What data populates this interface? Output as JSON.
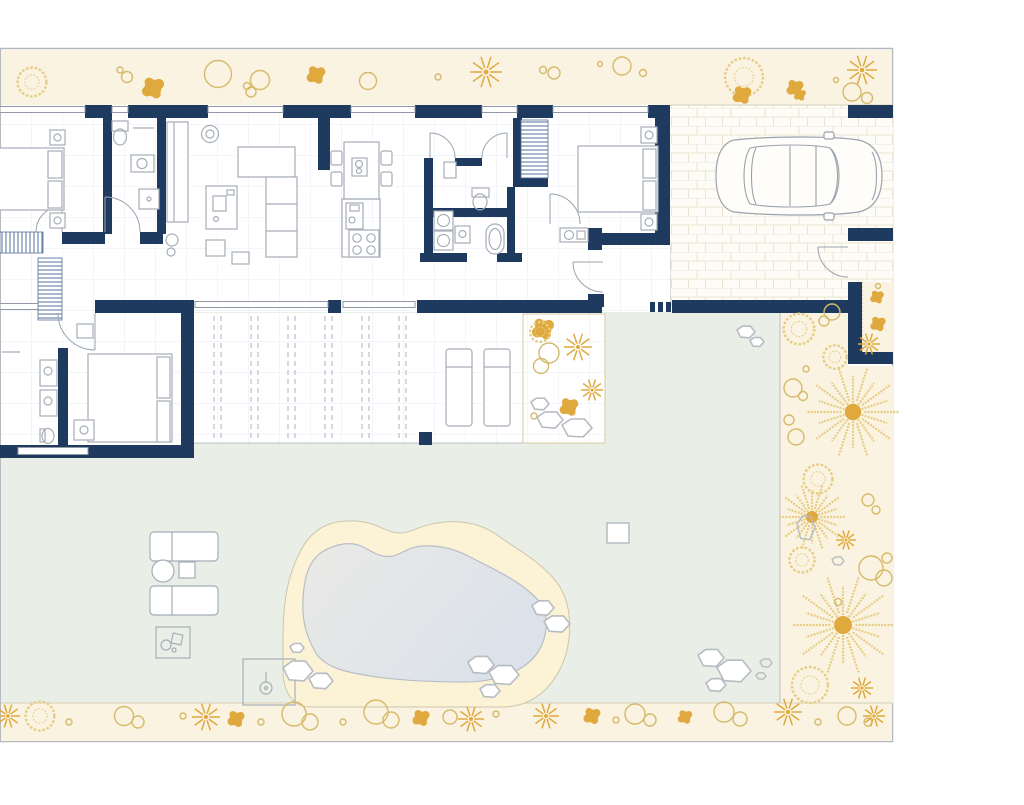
{
  "palette": {
    "wall": "#1e3b5f",
    "frame": "#b6bac0",
    "cream": "#faf3e2",
    "cream-line": "#d5cfb6",
    "green": "#e9efe6",
    "deck": "#fcf3d7",
    "deck-line": "#cdc6ab",
    "water1": "#eaeae7",
    "water2": "#dce2ea",
    "water-line": "#b9bec6",
    "gold": "#e0a93e",
    "gold-line": "#d6ba6b",
    "gold-soft": "#e7cd82",
    "furn": "#a6aeb8",
    "door": "#9aa3ae",
    "sand-line": "#d9c9a0"
  },
  "pergola": {
    "x1": 214,
    "x2": 406,
    "y1": 316,
    "y2": 440,
    "pair_gap": 7,
    "spacing": 37
  },
  "inventory": {
    "bedrooms": 3,
    "bathrooms": 3,
    "kitchen_islands": 1,
    "sofas": 1,
    "sun_loungers_terrace": 2,
    "sun_loungers_garden": 2,
    "cars": 1,
    "pools": 1,
    "palm_trees": 3,
    "outdoor_showers": 1,
    "staircases": 1
  },
  "decor": [
    {
      "t": "wreath",
      "x": 32,
      "y": 82,
      "s": 1.6
    },
    {
      "t": "circle",
      "x": 120,
      "y": 70,
      "s": 0.3
    },
    {
      "t": "circle",
      "x": 127,
      "y": 77,
      "s": 0.55
    },
    {
      "t": "blob",
      "x": 153,
      "y": 88,
      "s": 1.3
    },
    {
      "t": "circle",
      "x": 218,
      "y": 74,
      "s": 1.35
    },
    {
      "t": "circle",
      "x": 247,
      "y": 86,
      "s": 0.35
    },
    {
      "t": "circle",
      "x": 260,
      "y": 80,
      "s": 0.95
    },
    {
      "t": "circle",
      "x": 251,
      "y": 92,
      "s": 0.5
    },
    {
      "t": "blob",
      "x": 316,
      "y": 75,
      "s": 1.1
    },
    {
      "t": "circle",
      "x": 368,
      "y": 81,
      "s": 0.85
    },
    {
      "t": "circle",
      "x": 438,
      "y": 77,
      "s": 0.3
    },
    {
      "t": "star",
      "x": 486,
      "y": 72,
      "s": 1.6
    },
    {
      "t": "circle",
      "x": 543,
      "y": 70,
      "s": 0.35
    },
    {
      "t": "circle",
      "x": 554,
      "y": 73,
      "s": 0.6
    },
    {
      "t": "circle",
      "x": 600,
      "y": 64,
      "s": 0.25
    },
    {
      "t": "circle",
      "x": 622,
      "y": 66,
      "s": 0.9
    },
    {
      "t": "circle",
      "x": 643,
      "y": 73,
      "s": 0.35
    },
    {
      "t": "wreath",
      "x": 744,
      "y": 77,
      "s": 2.1
    },
    {
      "t": "blob",
      "x": 795,
      "y": 88,
      "s": 1.0
    },
    {
      "t": "star",
      "x": 862,
      "y": 70,
      "s": 1.5
    },
    {
      "t": "circle",
      "x": 852,
      "y": 92,
      "s": 0.9
    },
    {
      "t": "circle",
      "x": 867,
      "y": 98,
      "s": 0.55
    },
    {
      "t": "circle",
      "x": 836,
      "y": 80,
      "s": 0.25
    },
    {
      "t": "blob",
      "x": 742,
      "y": 95,
      "s": 1.1
    },
    {
      "t": "blob",
      "x": 800,
      "y": 95,
      "s": 0.7
    },
    {
      "t": "blob",
      "x": 877,
      "y": 297,
      "s": 0.8
    },
    {
      "t": "blob",
      "x": 878,
      "y": 324,
      "s": 0.9
    },
    {
      "t": "star",
      "x": 869,
      "y": 344,
      "s": 1.1
    },
    {
      "t": "circle",
      "x": 878,
      "y": 286,
      "s": 0.25
    },
    {
      "t": "wreath",
      "x": 799,
      "y": 329,
      "s": 1.7
    },
    {
      "t": "circle",
      "x": 824,
      "y": 321,
      "s": 0.5
    },
    {
      "t": "circle",
      "x": 832,
      "y": 312,
      "s": 0.8
    },
    {
      "t": "wreath",
      "x": 835,
      "y": 357,
      "s": 1.3
    },
    {
      "t": "circle",
      "x": 806,
      "y": 369,
      "s": 0.3
    },
    {
      "t": "circle",
      "x": 793,
      "y": 388,
      "s": 0.9
    },
    {
      "t": "circle",
      "x": 803,
      "y": 396,
      "s": 0.45
    },
    {
      "t": "palm",
      "x": 853,
      "y": 412,
      "s": 4.6
    },
    {
      "t": "circle",
      "x": 789,
      "y": 420,
      "s": 0.5
    },
    {
      "t": "circle",
      "x": 796,
      "y": 437,
      "s": 0.8
    },
    {
      "t": "wreath",
      "x": 818,
      "y": 479,
      "s": 1.6
    },
    {
      "t": "palm",
      "x": 812,
      "y": 517,
      "s": 3.4
    },
    {
      "t": "gstone",
      "x": 806,
      "y": 528,
      "w": 18,
      "h": 26
    },
    {
      "t": "star",
      "x": 846,
      "y": 540,
      "s": 1.0
    },
    {
      "t": "circle",
      "x": 868,
      "y": 500,
      "s": 0.6
    },
    {
      "t": "circle",
      "x": 876,
      "y": 510,
      "s": 0.4
    },
    {
      "t": "wreath",
      "x": 802,
      "y": 560,
      "s": 1.4
    },
    {
      "t": "gstone",
      "x": 838,
      "y": 561,
      "w": 12,
      "h": 9
    },
    {
      "t": "circle",
      "x": 871,
      "y": 568,
      "s": 1.2
    },
    {
      "t": "circle",
      "x": 884,
      "y": 578,
      "s": 0.8
    },
    {
      "t": "circle",
      "x": 887,
      "y": 558,
      "s": 0.5
    },
    {
      "t": "palm",
      "x": 843,
      "y": 625,
      "s": 5.0
    },
    {
      "t": "circle",
      "x": 838,
      "y": 602,
      "s": 0.35
    },
    {
      "t": "wreath",
      "x": 810,
      "y": 685,
      "s": 2.0
    },
    {
      "t": "star",
      "x": 862,
      "y": 688,
      "s": 1.1
    },
    {
      "t": "circle",
      "x": 868,
      "y": 722,
      "s": 0.4
    },
    {
      "t": "blob",
      "x": 543,
      "y": 329,
      "s": 1.3
    },
    {
      "t": "wreath",
      "x": 540,
      "y": 332,
      "s": 1.1
    },
    {
      "t": "star",
      "x": 578,
      "y": 347,
      "s": 1.4
    },
    {
      "t": "circle",
      "x": 549,
      "y": 353,
      "s": 1.0
    },
    {
      "t": "circle",
      "x": 541,
      "y": 366,
      "s": 0.75
    },
    {
      "t": "star",
      "x": 592,
      "y": 390,
      "s": 1.1
    },
    {
      "t": "blob",
      "x": 569,
      "y": 407,
      "s": 1.1
    },
    {
      "t": "circle",
      "x": 534,
      "y": 416,
      "s": 0.3
    },
    {
      "t": "stone",
      "x": 540,
      "y": 404,
      "w": 18,
      "h": 13
    },
    {
      "t": "stone",
      "x": 550,
      "y": 420,
      "w": 26,
      "h": 18
    },
    {
      "t": "stone",
      "x": 577,
      "y": 428,
      "w": 30,
      "h": 20
    },
    {
      "t": "stone",
      "x": 746,
      "y": 332,
      "w": 18,
      "h": 13
    },
    {
      "t": "stone",
      "x": 757,
      "y": 342,
      "w": 14,
      "h": 10
    },
    {
      "t": "stone",
      "x": 297,
      "y": 648,
      "w": 14,
      "h": 10
    },
    {
      "t": "stone",
      "x": 298,
      "y": 671,
      "w": 30,
      "h": 22
    },
    {
      "t": "stone",
      "x": 321,
      "y": 681,
      "w": 24,
      "h": 17
    },
    {
      "t": "stone",
      "x": 481,
      "y": 665,
      "w": 26,
      "h": 19
    },
    {
      "t": "stone",
      "x": 504,
      "y": 675,
      "w": 30,
      "h": 21
    },
    {
      "t": "stone",
      "x": 490,
      "y": 691,
      "w": 20,
      "h": 14
    },
    {
      "t": "stone",
      "x": 543,
      "y": 608,
      "w": 22,
      "h": 16
    },
    {
      "t": "stone",
      "x": 557,
      "y": 624,
      "w": 26,
      "h": 18
    },
    {
      "t": "stone",
      "x": 711,
      "y": 658,
      "w": 26,
      "h": 19
    },
    {
      "t": "stone",
      "x": 734,
      "y": 671,
      "w": 34,
      "h": 24
    },
    {
      "t": "stone",
      "x": 716,
      "y": 685,
      "w": 20,
      "h": 14
    },
    {
      "t": "gstone",
      "x": 766,
      "y": 663,
      "w": 12,
      "h": 9
    },
    {
      "t": "gstone",
      "x": 761,
      "y": 676,
      "w": 10,
      "h": 7
    },
    {
      "t": "star",
      "x": 8,
      "y": 716,
      "s": 1.2
    },
    {
      "t": "wreath",
      "x": 40,
      "y": 716,
      "s": 1.6
    },
    {
      "t": "circle",
      "x": 69,
      "y": 722,
      "s": 0.3
    },
    {
      "t": "circle",
      "x": 124,
      "y": 716,
      "s": 0.95
    },
    {
      "t": "circle",
      "x": 138,
      "y": 722,
      "s": 0.6
    },
    {
      "t": "circle",
      "x": 183,
      "y": 716,
      "s": 0.3
    },
    {
      "t": "star",
      "x": 206,
      "y": 717,
      "s": 1.4
    },
    {
      "t": "blob",
      "x": 236,
      "y": 719,
      "s": 1.0
    },
    {
      "t": "circle",
      "x": 261,
      "y": 722,
      "s": 0.3
    },
    {
      "t": "circle",
      "x": 294,
      "y": 714,
      "s": 1.2
    },
    {
      "t": "circle",
      "x": 310,
      "y": 722,
      "s": 0.8
    },
    {
      "t": "circle",
      "x": 343,
      "y": 722,
      "s": 0.3
    },
    {
      "t": "circle",
      "x": 376,
      "y": 712,
      "s": 1.2
    },
    {
      "t": "circle",
      "x": 391,
      "y": 720,
      "s": 0.8
    },
    {
      "t": "blob",
      "x": 421,
      "y": 718,
      "s": 1.0
    },
    {
      "t": "circle",
      "x": 450,
      "y": 717,
      "s": 0.7
    },
    {
      "t": "star",
      "x": 471,
      "y": 719,
      "s": 1.3
    },
    {
      "t": "circle",
      "x": 496,
      "y": 714,
      "s": 0.3
    },
    {
      "t": "star",
      "x": 546,
      "y": 716,
      "s": 1.3
    },
    {
      "t": "blob",
      "x": 592,
      "y": 716,
      "s": 1.0
    },
    {
      "t": "circle",
      "x": 616,
      "y": 720,
      "s": 0.3
    },
    {
      "t": "circle",
      "x": 635,
      "y": 714,
      "s": 1.0
    },
    {
      "t": "circle",
      "x": 650,
      "y": 720,
      "s": 0.6
    },
    {
      "t": "blob",
      "x": 685,
      "y": 717,
      "s": 0.85
    },
    {
      "t": "circle",
      "x": 724,
      "y": 712,
      "s": 1.0
    },
    {
      "t": "circle",
      "x": 740,
      "y": 719,
      "s": 0.7
    },
    {
      "t": "star",
      "x": 788,
      "y": 712,
      "s": 1.4
    },
    {
      "t": "circle",
      "x": 818,
      "y": 722,
      "s": 0.3
    },
    {
      "t": "circle",
      "x": 847,
      "y": 716,
      "s": 0.9
    },
    {
      "t": "star",
      "x": 874,
      "y": 716,
      "s": 1.1
    }
  ]
}
